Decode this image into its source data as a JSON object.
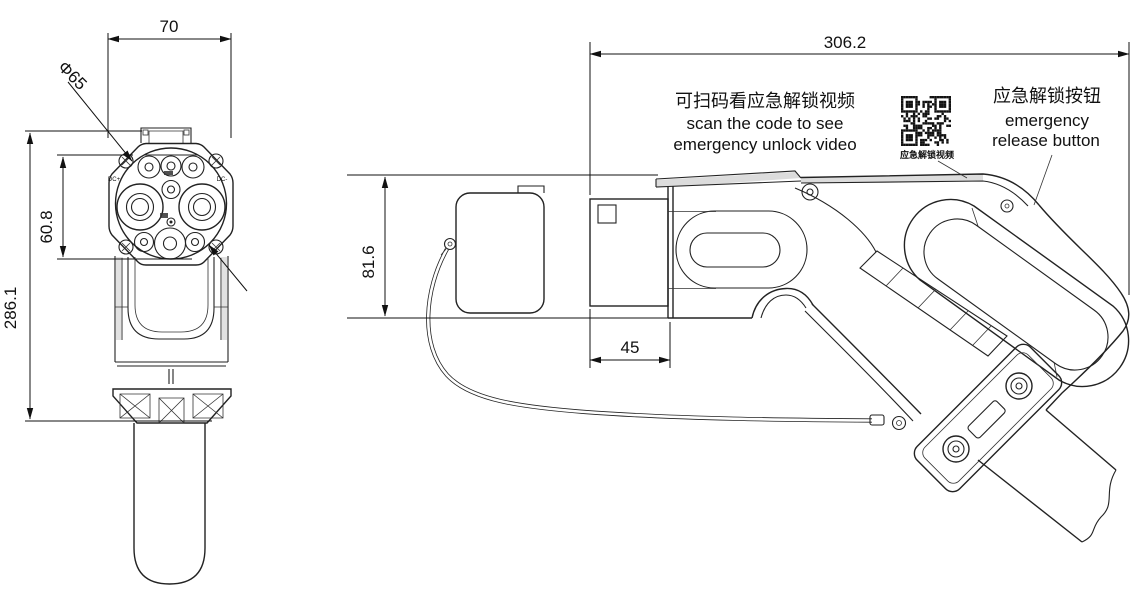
{
  "front_view": {
    "dim_width": "70",
    "dim_diameter": "Φ65",
    "dim_insert_height": "60.8",
    "dim_total_height": "286.1",
    "pin_label_dc_plus": "DC+",
    "pin_label_dc_minus": "DC-"
  },
  "side_view": {
    "dim_length": "306.2",
    "dim_height": "81.6",
    "dim_nozzle_depth": "45",
    "scan_note_zh": "可扫码看应急解锁视频",
    "scan_note_en_line1": "scan the code to see",
    "scan_note_en_line2": "emergency unlock video",
    "qr_caption": "应急解锁视频",
    "button_note_zh": "应急解锁按钮",
    "button_note_en_line1": "emergency",
    "button_note_en_line2": "release button"
  },
  "colors": {
    "line": "#222222",
    "background": "#ffffff",
    "dim_text": "#111111"
  }
}
